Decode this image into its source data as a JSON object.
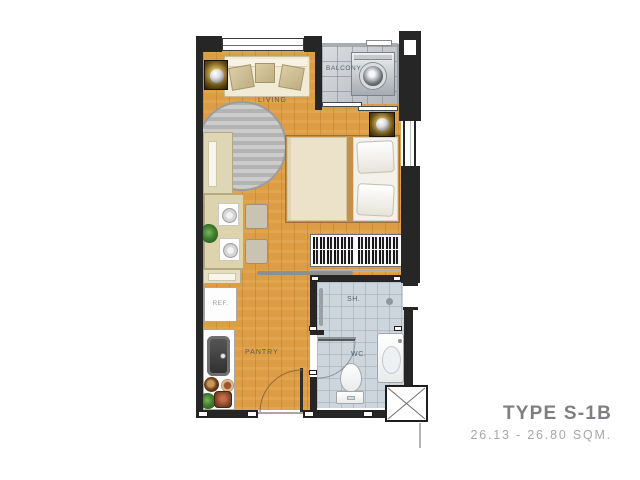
{
  "title_block": {
    "type_label": "TYPE S-1B",
    "area_label": "26.13 - 26.80 SQM."
  },
  "labels": {
    "living": "LIVING",
    "balcony": "BALCONY",
    "pantry": "PANTRY",
    "refrigerator": "REF.",
    "shower": "SH.",
    "toilet": "WC."
  },
  "colors": {
    "floor_wood": "#DD9D44",
    "wall_dark": "#262626",
    "balcony_tile": "#BDC2C8",
    "bathroom_tile": "#CED6DD",
    "counter_cream": "#DED6B4",
    "rug_grey": "#BDBDBD",
    "title_grey": "#7D7F82",
    "subtitle_grey": "#A5A7AA"
  }
}
